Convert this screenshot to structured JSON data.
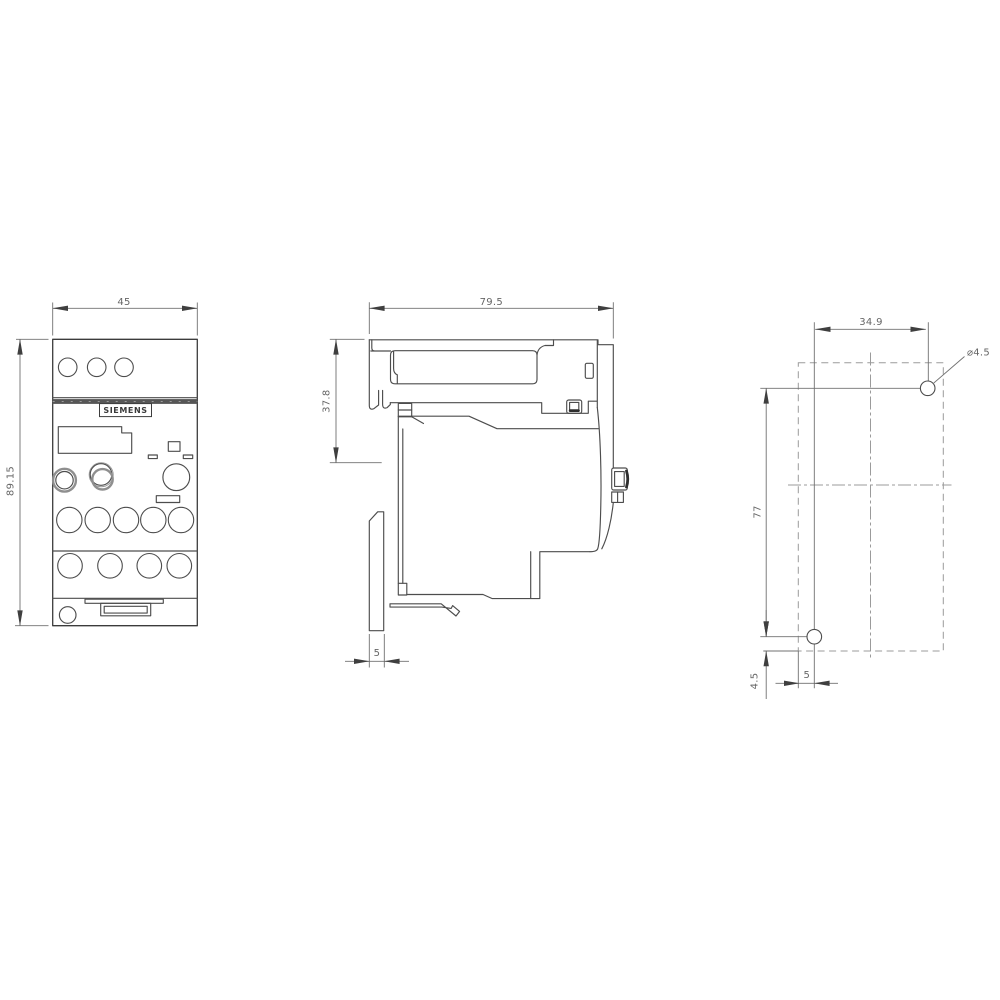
{
  "drawing": {
    "brand_label": "SIEMENS",
    "front_view": {
      "width": "45",
      "height": "89.15"
    },
    "side_view": {
      "depth": "79.5",
      "upper_height": "37.8",
      "plate_thickness": "5"
    },
    "drilling_plan": {
      "hole_spacing_horizontal": "34.9",
      "hole_diameter": "⌀4.5",
      "hole_spacing_vertical": "77",
      "bottom_hole_edge_offset": "4.5",
      "left_hole_edge_offset": "5"
    }
  }
}
